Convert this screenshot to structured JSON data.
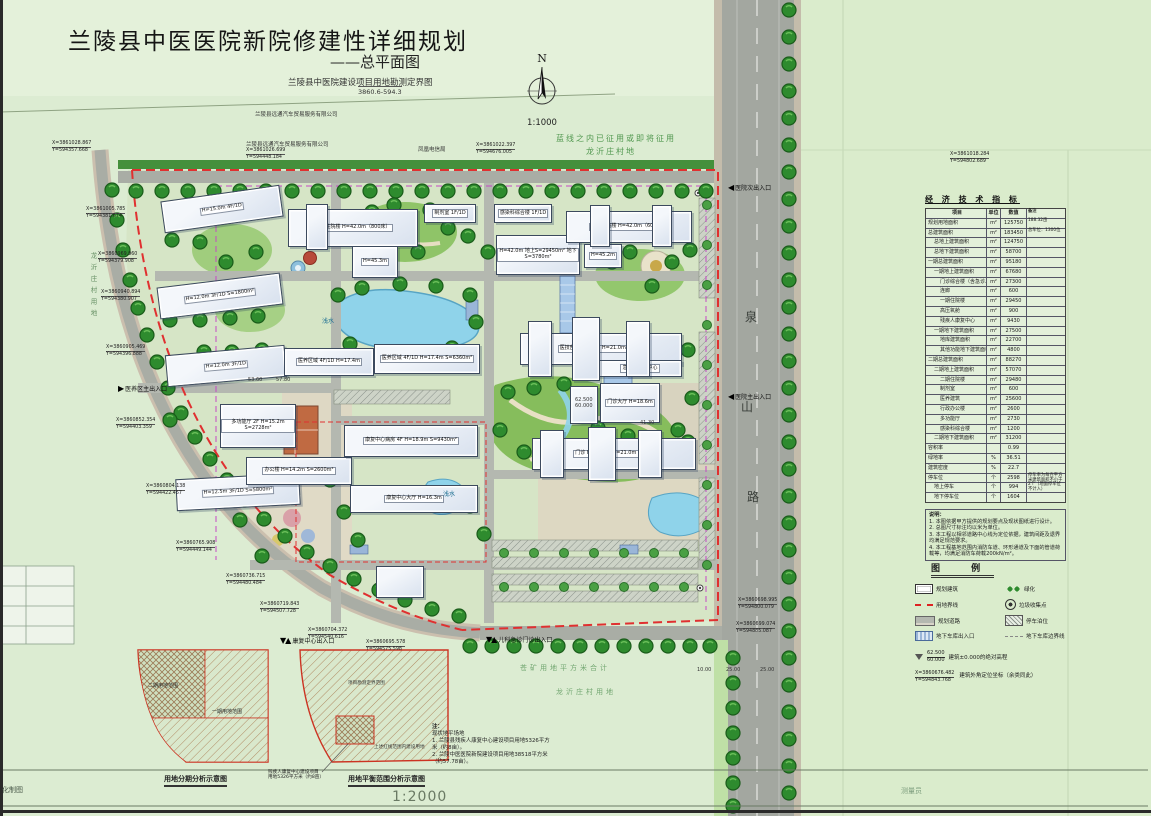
{
  "title_block": {
    "title": "兰陵县中医医院新院修建性详细规划",
    "subtitle": "——总平面图",
    "survey_title": "兰陵县中医院建设项目用地勘测定界图",
    "survey_code": "3860.6-594.3"
  },
  "compass": {
    "n": "N",
    "scale": "1:1000"
  },
  "colors": {
    "boundary_red": "#e03030",
    "road_gray": "#a9ada5",
    "tree_green": "#2e8b2e",
    "water_blue": "#8fd3ea",
    "garage_line_magenta": "#c44ac4"
  },
  "indicator_table": {
    "title": "经 济 技 术 指 标",
    "columns": [
      "项目",
      "单位",
      "数值",
      "备注"
    ],
    "rows": [
      {
        "item": "规划用地面积",
        "unit": "m²",
        "value": "125750",
        "note": "188.32亩",
        "ind": 2
      },
      {
        "item": "总建筑面积",
        "unit": "m²",
        "value": "183450",
        "note": "总车位：1300位",
        "ind": 2
      },
      {
        "item": "总地上建筑面积",
        "unit": "m²",
        "value": "124750",
        "note": "",
        "ind": 8
      },
      {
        "item": "总地下建筑面积",
        "unit": "m²",
        "value": "58700",
        "note": "",
        "ind": 8
      },
      {
        "item": "一期总建筑面积",
        "unit": "m²",
        "value": "95180",
        "note": "",
        "ind": 2
      },
      {
        "item": "一期地上建筑面积",
        "unit": "m²",
        "value": "67680",
        "note": "",
        "ind": 8
      },
      {
        "item": "门诊综合楼（含急诊、医技）",
        "unit": "m²",
        "value": "27300",
        "note": "",
        "ind": 14
      },
      {
        "item": "连廊",
        "unit": "m²",
        "value": "600",
        "note": "",
        "ind": 14
      },
      {
        "item": "一期住院楼",
        "unit": "m²",
        "value": "29450",
        "note": "",
        "ind": 14
      },
      {
        "item": "高压氧舱",
        "unit": "m²",
        "value": "900",
        "note": "",
        "ind": 14
      },
      {
        "item": "残疾人康复中心",
        "unit": "m²",
        "value": "9430",
        "note": "",
        "ind": 14
      },
      {
        "item": "一期地下建筑面积",
        "unit": "m²",
        "value": "27500",
        "note": "",
        "ind": 8
      },
      {
        "item": "地库建筑面积",
        "unit": "m²",
        "value": "22700",
        "note": "",
        "ind": 14
      },
      {
        "item": "其他功能地下建筑面积",
        "unit": "m²",
        "value": "4800",
        "note": "",
        "ind": 14
      },
      {
        "item": "二期总建筑面积",
        "unit": "m²",
        "value": "88270",
        "note": "",
        "ind": 2
      },
      {
        "item": "二期地上建筑面积",
        "unit": "m²",
        "value": "57070",
        "note": "",
        "ind": 8
      },
      {
        "item": "二期住院楼",
        "unit": "m²",
        "value": "29480",
        "note": "",
        "ind": 14
      },
      {
        "item": "制剂室",
        "unit": "m²",
        "value": "600",
        "note": "",
        "ind": 14
      },
      {
        "item": "医养建筑",
        "unit": "m²",
        "value": "25600",
        "note": "",
        "ind": 14
      },
      {
        "item": "行政办公楼",
        "unit": "m²",
        "value": "2600",
        "note": "",
        "ind": 14
      },
      {
        "item": "多功能厅",
        "unit": "m²",
        "value": "2730",
        "note": "",
        "ind": 14
      },
      {
        "item": "感染科综合楼",
        "unit": "m²",
        "value": "1200",
        "note": "",
        "ind": 14
      },
      {
        "item": "二期地下建筑面积",
        "unit": "m²",
        "value": "31200",
        "note": "",
        "ind": 8
      },
      {
        "item": "容积率",
        "unit": "",
        "value": "0.99",
        "note": "",
        "ind": 2
      },
      {
        "item": "绿地率",
        "unit": "%",
        "value": "36.51",
        "note": "",
        "ind": 2
      },
      {
        "item": "建筑密度",
        "unit": "%",
        "value": "22.7",
        "note": "",
        "ind": 2
      },
      {
        "item": "停车位",
        "unit": "个",
        "value": "2598",
        "note": "停车率为每百平方米建筑面积不小于2个（地面停车位不计入）",
        "ind": 2
      },
      {
        "item": "地上停车",
        "unit": "个",
        "value": "994",
        "note": "",
        "ind": 8
      },
      {
        "item": "地下停车位",
        "unit": "个",
        "value": "1604",
        "note": "",
        "ind": 8
      }
    ]
  },
  "notes": {
    "title": "说明：",
    "lines": [
      "1. 本图依据甲方提供的规划要点及现状图纸进行设计。",
      "2. 总图尺寸标注均以米为单位。",
      "3. 本工程以相邻道路中心线为定位依据，建筑间距及退界均满足规范要求。",
      "4. 本工程基地范围内消防车道、环形通道及下面的管道荷载等，均满足消防车荷载200kN/m²。"
    ]
  },
  "legend": {
    "title": "图  例",
    "items": [
      {
        "icon": "planned-building-symbol",
        "sym": "building",
        "label": "规划建筑"
      },
      {
        "icon": "greenery-symbol",
        "sym": "green",
        "label": "绿化"
      },
      {
        "icon": "site-boundary-symbol",
        "sym": "redline",
        "label": "用地界线"
      },
      {
        "icon": "trash-point-symbol",
        "sym": "trash",
        "label": "垃圾收集点"
      },
      {
        "icon": "planned-road-symbol",
        "sym": "road",
        "label": "规划道路"
      },
      {
        "icon": "parking-symbol",
        "sym": "parking",
        "label": "停车泊位"
      },
      {
        "icon": "garage-entry-symbol",
        "sym": "ramp",
        "label": "地下车库出入口"
      },
      {
        "icon": "garage-boundary-symbol",
        "sym": "grayline",
        "label": "地下车库边界线"
      }
    ],
    "elevation": {
      "top": "62.500",
      "bottom": "60.000",
      "label": "建筑±0.000的绝对高程"
    },
    "corner": {
      "l1": "X=3860676.482",
      "l2": "Y=594843.768",
      "label": "建筑外角定位坐标（余类同此）"
    }
  },
  "map": {
    "buildings": [
      {
        "x": 162,
        "y": 193,
        "w": 118,
        "h": 30,
        "tf": "-8deg",
        "label": "H=15.0m 4F/1D"
      },
      {
        "x": 158,
        "y": 280,
        "w": 122,
        "h": 30,
        "tf": "-7deg",
        "label": "H=12.0m 3F/1D S=1800m²"
      },
      {
        "x": 166,
        "y": 350,
        "w": 118,
        "h": 30,
        "tf": "-5deg",
        "label": "H=12.0m 3F/1D"
      },
      {
        "x": 176,
        "y": 476,
        "w": 122,
        "h": 30,
        "tf": "-3deg",
        "label": "H=12.5m 3F/1D S=5800m²"
      },
      {
        "x": 220,
        "y": 404,
        "w": 74,
        "h": 42,
        "label": "多功能厅 2F H=15.2m S=2728m²"
      },
      {
        "x": 246,
        "y": 457,
        "w": 104,
        "h": 26,
        "label": "办公楼 H=14.2m S=2600m²"
      },
      {
        "x": 284,
        "y": 348,
        "w": 88,
        "h": 26,
        "label": "医养区域 4F/1D H=17.4m"
      },
      {
        "x": 374,
        "y": 344,
        "w": 104,
        "h": 28,
        "label": "医养区域 4F/1D H=17.4m S=6360m²"
      },
      {
        "x": 288,
        "y": 209,
        "w": 128,
        "h": 36,
        "label": "二期住院楼 H=42.0m（800床）"
      },
      {
        "x": 352,
        "y": 246,
        "w": 44,
        "h": 30,
        "label": "H=45.3m"
      },
      {
        "x": 424,
        "y": 204,
        "w": 50,
        "h": 17,
        "label": "制剂室 1F/1D"
      },
      {
        "x": 494,
        "y": 204,
        "w": 56,
        "h": 17,
        "label": "感染科综合楼 1F/1D"
      },
      {
        "x": 496,
        "y": 235,
        "w": 82,
        "h": 38,
        "label": "H=42.0m 地上S=29450m² 地下S=3780m²"
      },
      {
        "x": 566,
        "y": 211,
        "w": 124,
        "h": 30,
        "label": "一期住院楼 H=42.0m（600床）"
      },
      {
        "x": 584,
        "y": 244,
        "w": 36,
        "h": 22,
        "label": "H=45.2m"
      },
      {
        "x": 520,
        "y": 333,
        "w": 160,
        "h": 30,
        "label": "医技部 H=26.9m H=21.0m 4F/1D"
      },
      {
        "x": 598,
        "y": 360,
        "w": 82,
        "h": 15,
        "label": "急诊、急救中心"
      },
      {
        "x": 600,
        "y": 383,
        "w": 58,
        "h": 38,
        "label": "门诊大厅 H=18.6m"
      },
      {
        "x": 532,
        "y": 438,
        "w": 162,
        "h": 30,
        "label": "门诊 H=24.9m H=21.0m 4F/1D"
      },
      {
        "x": 344,
        "y": 425,
        "w": 132,
        "h": 30,
        "label": "康复中心病房 4F H=18.9m S=9430m²"
      },
      {
        "x": 350,
        "y": 485,
        "w": 126,
        "h": 26,
        "label": "康复中心大厅 H=16.3m"
      },
      {
        "x": 528,
        "y": 321,
        "w": 22,
        "h": 54,
        "label": ""
      },
      {
        "x": 572,
        "y": 317,
        "w": 26,
        "h": 62,
        "label": ""
      },
      {
        "x": 626,
        "y": 321,
        "w": 22,
        "h": 54,
        "label": ""
      },
      {
        "x": 540,
        "y": 430,
        "w": 22,
        "h": 46,
        "label": ""
      },
      {
        "x": 588,
        "y": 427,
        "w": 26,
        "h": 52,
        "label": ""
      },
      {
        "x": 638,
        "y": 430,
        "w": 22,
        "h": 46,
        "label": ""
      },
      {
        "x": 590,
        "y": 205,
        "w": 18,
        "h": 40,
        "label": ""
      },
      {
        "x": 652,
        "y": 205,
        "w": 18,
        "h": 40,
        "label": ""
      },
      {
        "x": 306,
        "y": 204,
        "w": 20,
        "h": 44,
        "label": ""
      },
      {
        "x": 376,
        "y": 566,
        "w": 46,
        "h": 30,
        "label": ""
      },
      {
        "x": 570,
        "y": 386,
        "w": 26,
        "h": 36,
        "label": ""
      }
    ],
    "annotations": [
      {
        "x": 556,
        "y": 133,
        "text": "蓝线之内已征用或即将征用",
        "cls": "map-label green"
      },
      {
        "x": 586,
        "y": 146,
        "text": "龙沂庄村地",
        "cls": "map-label green"
      },
      {
        "x": 255,
        "y": 110,
        "text": "兰陵县远通汽车贸易服务有限公司",
        "cls": "map-label tiny"
      },
      {
        "x": 246,
        "y": 140,
        "text": "兰陵县远通汽车贸易服务有限公司",
        "cls": "map-label tiny"
      },
      {
        "x": 418,
        "y": 145,
        "text": "凤凰电信局",
        "cls": "map-label tiny"
      },
      {
        "x": 322,
        "y": 316,
        "text": "浅水",
        "cls": "map-label water"
      },
      {
        "x": 443,
        "y": 489,
        "text": "浅水",
        "cls": "map-label water"
      },
      {
        "x": 745,
        "y": 308,
        "text": "泉",
        "cls": "map-label roadname"
      },
      {
        "x": 741,
        "y": 398,
        "text": "山",
        "cls": "map-label roadname"
      },
      {
        "x": 747,
        "y": 488,
        "text": "路",
        "cls": "map-label roadname"
      },
      {
        "x": 520,
        "y": 663,
        "text": "苍矿用地平方米合计",
        "cls": "map-label green2"
      },
      {
        "x": 556,
        "y": 687,
        "text": "龙沂庄村用地",
        "cls": "map-label green2"
      },
      {
        "x": 88,
        "y": 252,
        "text": "龙沂庄村用地",
        "cls": "map-label green-vert"
      },
      {
        "x": 697,
        "y": 667,
        "text": "10.00",
        "cls": "map-label dim"
      },
      {
        "x": 726,
        "y": 667,
        "text": "25.00",
        "cls": "map-label dim"
      },
      {
        "x": 760,
        "y": 667,
        "text": "25.00",
        "cls": "map-label dim"
      },
      {
        "x": 248,
        "y": 377,
        "text": "53.60",
        "cls": "map-label dim"
      },
      {
        "x": 276,
        "y": 377,
        "text": "57.80",
        "cls": "map-label dim"
      },
      {
        "x": 640,
        "y": 420,
        "text": "41.30",
        "cls": "map-label dim"
      },
      {
        "x": 575,
        "y": 397,
        "text": "62.500",
        "cls": "map-label dim"
      },
      {
        "x": 575,
        "y": 403,
        "text": "60.000",
        "cls": "map-label dim"
      },
      {
        "x": 2,
        "y": 785,
        "text": "化制图",
        "cls": "map-label footer-left"
      },
      {
        "x": 901,
        "y": 786,
        "text": "测量员",
        "cls": "map-label footer-right"
      }
    ],
    "entrances": [
      {
        "x": 728,
        "y": 183,
        "arrows": "◀",
        "label": "医院次出入口"
      },
      {
        "x": 728,
        "y": 392,
        "arrows": "◀",
        "label": "医院主出入口"
      },
      {
        "x": 118,
        "y": 384,
        "arrows": "▶",
        "label": "医养区主出入口"
      },
      {
        "x": 280,
        "y": 636,
        "arrows": "▼▲",
        "label": "康复中心出入口"
      },
      {
        "x": 486,
        "y": 635,
        "arrows": "▼▲",
        "label": "儿科急诊门诊出入口"
      }
    ],
    "coords": [
      {
        "x": 52,
        "y": 141,
        "l1": "X=3861028.867",
        "l2": "Y=594357.668"
      },
      {
        "x": 246,
        "y": 148,
        "l1": "X=3861026.699",
        "l2": "Y=594448.184"
      },
      {
        "x": 476,
        "y": 143,
        "l1": "X=3861022.397",
        "l2": "Y=594676.005"
      },
      {
        "x": 950,
        "y": 152,
        "l1": "X=3861018.284",
        "l2": "Y=594802.689"
      },
      {
        "x": 86,
        "y": 207,
        "l1": "X=3861005.785",
        "l2": "Y=594381.674"
      },
      {
        "x": 98,
        "y": 252,
        "l1": "X=3860969.960",
        "l2": "Y=594379.908"
      },
      {
        "x": 101,
        "y": 290,
        "l1": "X=3860940.894",
        "l2": "Y=594380.907"
      },
      {
        "x": 106,
        "y": 345,
        "l1": "X=3860905.469",
        "l2": "Y=594396.888"
      },
      {
        "x": 116,
        "y": 418,
        "l1": "X=3860852.354",
        "l2": "Y=594403.359"
      },
      {
        "x": 146,
        "y": 484,
        "l1": "X=3860804.138",
        "l2": "Y=594422.457"
      },
      {
        "x": 176,
        "y": 541,
        "l1": "X=3860765.908",
        "l2": "Y=594449.144"
      },
      {
        "x": 226,
        "y": 574,
        "l1": "X=3860736.715",
        "l2": "Y=594480.484"
      },
      {
        "x": 260,
        "y": 602,
        "l1": "X=3860719.843",
        "l2": "Y=594507.728"
      },
      {
        "x": 308,
        "y": 628,
        "l1": "X=3860704.372",
        "l2": "Y=594540.616"
      },
      {
        "x": 366,
        "y": 640,
        "l1": "X=3860695.578",
        "l2": "Y=594575.598"
      },
      {
        "x": 738,
        "y": 598,
        "l1": "X=3860698.995",
        "l2": "Y=594800.079"
      },
      {
        "x": 736,
        "y": 622,
        "l1": "X=3860699.074",
        "l2": "Y=594885.087"
      }
    ]
  },
  "insets": {
    "phase": {
      "caption": "用地分期分析示意图",
      "label1": "二期用地范围",
      "label2": "一期用地范围"
    },
    "balance": {
      "caption": "用地平衡范围分析示意图",
      "label1": "项目勘测定界范围",
      "label2": "上述红线范围内建设用地",
      "callout1": "残疾人康复中心建设项目",
      "callout2": "用地5326平方米（约8亩）"
    },
    "scale": "1:2000"
  },
  "bottom_note": {
    "title": "注：",
    "lines": [
      "现状地平场地",
      "1. 兰陵县残疾人康复中心建设项目用地5326平方",
      "米（约8亩）。",
      "2. 兰陵中医医院新院建设项目用地38518平方米",
      "（约57.78亩）。"
    ]
  }
}
